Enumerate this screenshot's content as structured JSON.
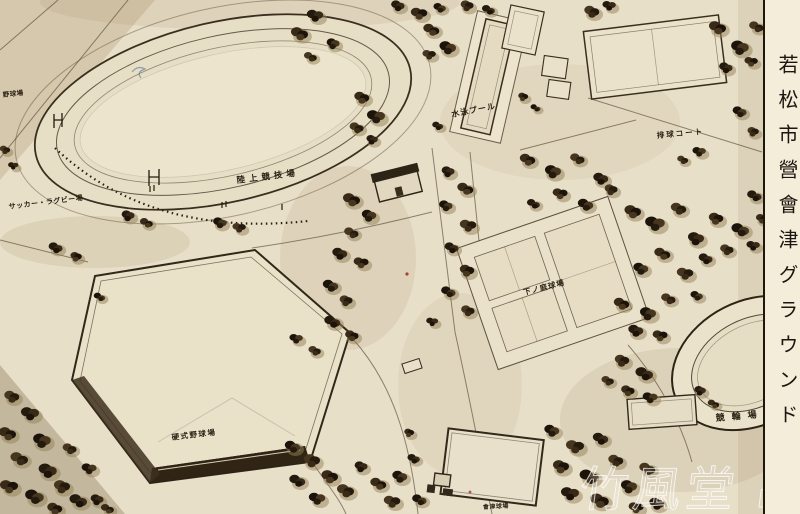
{
  "postcard": {
    "title": "若松市營會津グラウンド",
    "watermark": "竹風堂 出品",
    "labels": {
      "small_ballfield": "野球場",
      "soccer_rugby": "サッカー・ラグビー場",
      "athletics": "陸上競技場",
      "pool": "水泳プール",
      "volleyball_court": "排球コート",
      "tennis_courts": "下ノ庭球場",
      "baseball": "硬式野球場",
      "cycle_track": "競輪場",
      "bottom_small": "會津球場"
    },
    "colors": {
      "paper": "#e8dfc9",
      "ink": "#2b2114",
      "tree_dark": "#241a0d",
      "strip": "#f3edda",
      "watermark": "#ffffff"
    }
  }
}
